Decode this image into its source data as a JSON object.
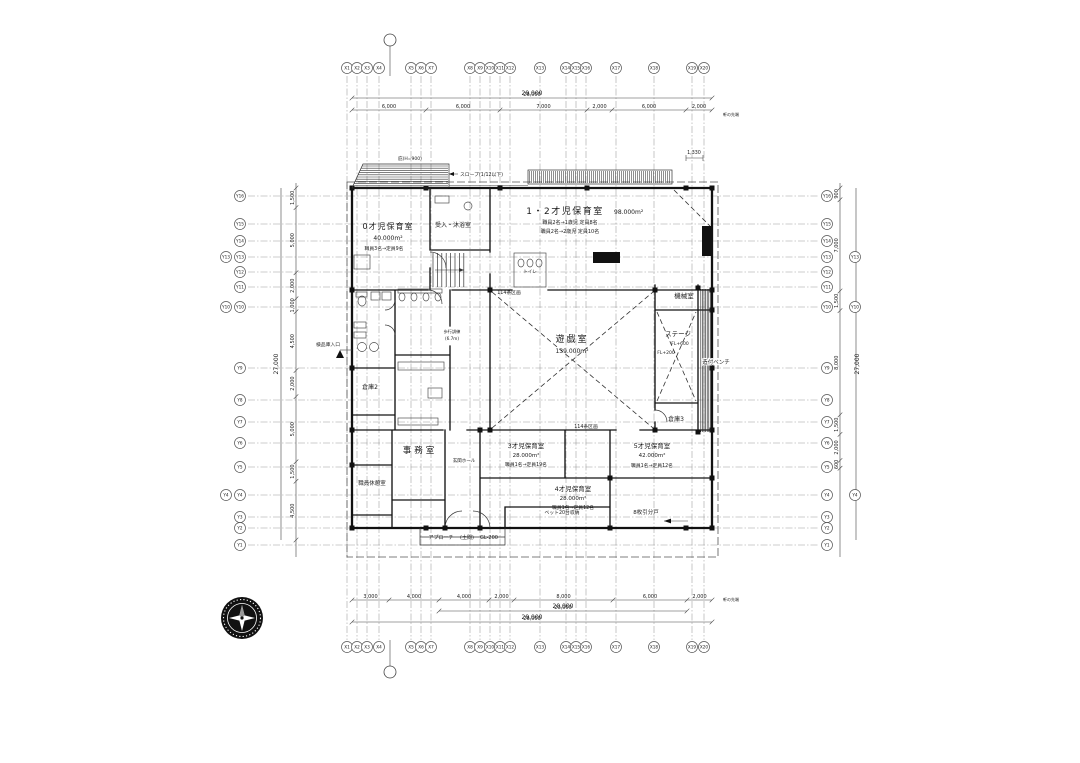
{
  "grid": {
    "x_labels": [
      "X1",
      "X2",
      "X3",
      "X4",
      "X5",
      "X6",
      "X7",
      "X8",
      "X9",
      "X10",
      "X11",
      "X12",
      "X13",
      "X14",
      "X15",
      "X16",
      "X17",
      "X18",
      "X19",
      "X20"
    ],
    "y_labels": [
      "Y16",
      "Y15",
      "Y14",
      "Y13",
      "Y12",
      "Y11",
      "Y10",
      "Y9",
      "Y8",
      "Y7",
      "Y6",
      "Y5",
      "Y4",
      "Y3",
      "Y2",
      "Y1"
    ]
  },
  "dims": {
    "top_total": "29,000",
    "top_segs": [
      "6,000",
      "6,000",
      "7,000",
      "2,000",
      "6,000",
      "2,000"
    ],
    "top_sub": "1,330",
    "bot_segs": [
      "3,000",
      "4,000",
      "4,000",
      "2,000",
      "8,000",
      "6,000",
      "2,000"
    ],
    "bot_sub": "20,000",
    "bot_total": "29,000",
    "left_total": "27,000",
    "left_segs": [
      "1,500",
      "5,000",
      "2,000",
      "1,000",
      "4,500",
      "2,000",
      "5,000",
      "1,500",
      "4,500"
    ],
    "right_total": "27,000",
    "right_segs": [
      "900",
      "7,000",
      "1,500",
      "8,000",
      "1,500",
      "2,000",
      "600"
    ],
    "eaves_note": "軒の先端"
  },
  "rooms": {
    "r0": {
      "name": "0才児保育室",
      "area": "40.000m²",
      "staff": "職員3名→定員9名"
    },
    "uketsuke": {
      "name": "受入・沐浴室"
    },
    "r12": {
      "name": "1・2才児保育室",
      "area": "98.000m²",
      "staff1": "職員2名→1歳児 定員8名",
      "staff2": "職員2名→2歳児 定員10名"
    },
    "toilet": {
      "name": "トイレ"
    },
    "machine": {
      "name": "機械室"
    },
    "play": {
      "name": "遊戯室",
      "area": "139.000m²"
    },
    "stage": {
      "name": "ステージ",
      "fl": "FL+600",
      "fl2": "FL+200"
    },
    "bench": {
      "name": "造付ベンチ"
    },
    "souko3": {
      "name": "倉庫3"
    },
    "souko2": {
      "name": "倉庫2"
    },
    "office": {
      "name": "事務室"
    },
    "hall": {
      "name": "玄関ホール"
    },
    "rest": {
      "name": "職員休憩室"
    },
    "r3": {
      "name": "3才児保育室",
      "area": "28.000m²",
      "staff": "職員1名→定員19名"
    },
    "r4": {
      "name": "4才児保育室",
      "area": "28.000m²",
      "staff": "職員1名→定員12名"
    },
    "r5": {
      "name": "5才児保育室",
      "area": "42.000m²",
      "staff": "職員1名→定員12名"
    }
  },
  "annotations": {
    "slope": "スロープ(1/12以下)",
    "hisashi": "庇(H=900)",
    "kukaku": "114条区画",
    "hokou1": "歩行訓練",
    "hokou2": "(6.7m)",
    "bed": "ベット20台収納",
    "door8": "8枚引分戸",
    "approach": "アプローチ",
    "doma": "(土間)",
    "gl": "GL-200",
    "kenpin": "検品庫入口"
  }
}
